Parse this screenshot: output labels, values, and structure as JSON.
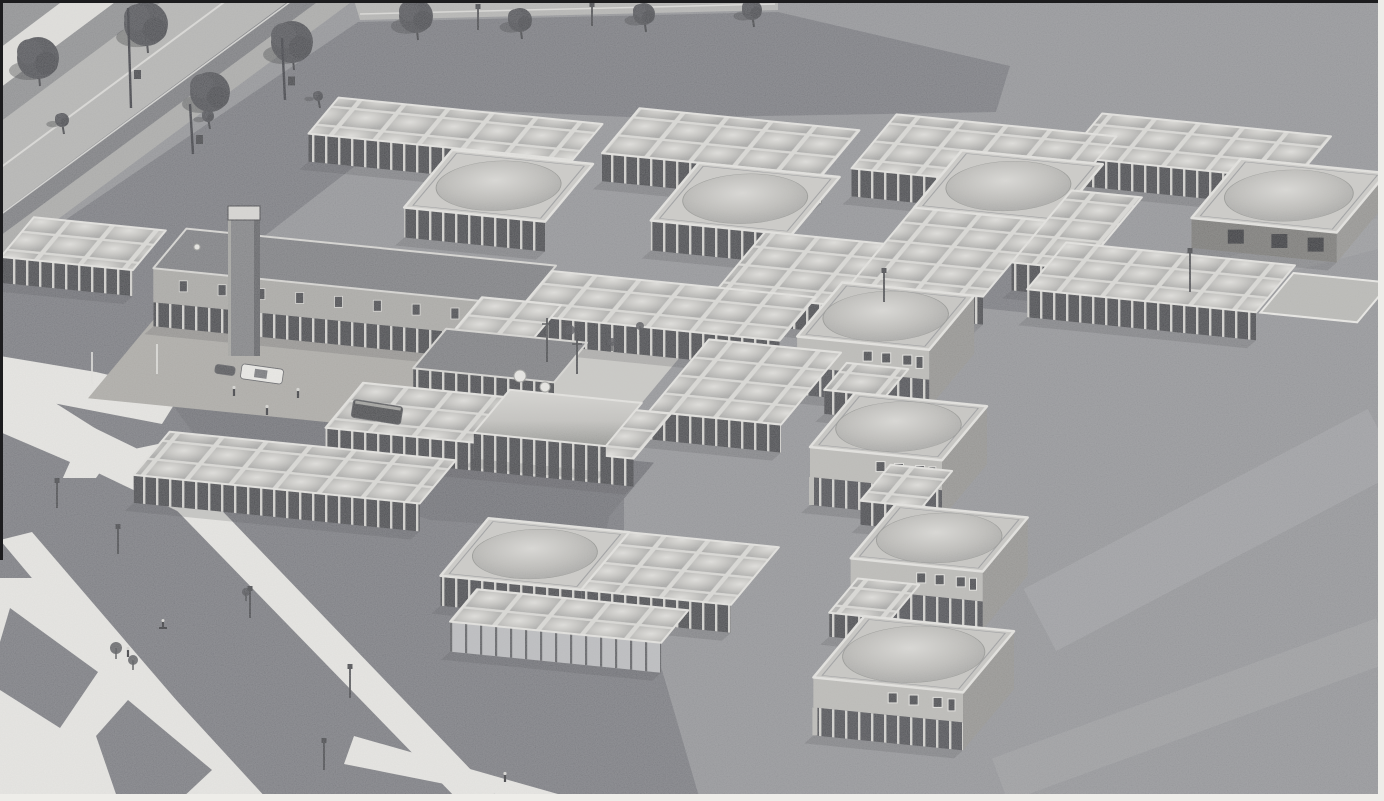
{
  "meta": {
    "title": "Aerial photograph of a modular pavilion building complex",
    "description": "Black-and-white oblique aerial photograph of a sprawling low-rise building complex composed of a carpet of square roof modules with domed skylights, larger pyramid-roofed pavilions, a long two-storey wing with a tower, and stepped two-storey dwelling blocks, surrounded by dark lawns, a tree-lined road at the upper left, bright diagonal footpaths at the lower left and a wide open field to the right."
  },
  "scene": {
    "palette": {
      "field": "#8e8f93",
      "lawn": "#73747a",
      "lawnDeep": "#696a70",
      "road": "#b2b2b0",
      "sidewalk": "#e3e2de",
      "verge": "#8a8b8d",
      "shadowBand": "#75767a",
      "cycle": "#a7a7a5",
      "path": "#eae9e5",
      "plaza": "#a9a7a2",
      "court": "#c9c8c4",
      "terrace": "#b6b6b2",
      "pavRoof": "#cbcac6",
      "houseRoof": "#c6c5c1",
      "spineRoof": "#76777b",
      "fascia": "#e7e6e2",
      "wallLight": "#c8c7c3",
      "wallWest": "#a8a7a3",
      "wallEast": "#8f8e8b",
      "plaster": "#b9b8b4",
      "glassDark": "#3e3f43",
      "glassLight": "#b9babd",
      "postLight": "#d3d2ce",
      "postDark": "#55565a",
      "darkWall": "#73726f",
      "tree": "#45464b",
      "shadow": "#3a3b3f",
      "white": "#eeede9",
      "ink": "#1c1c1e"
    },
    "basis": {
      "u": [
        44,
        4.4
      ],
      "v": [
        -15,
        18
      ],
      "origin": [
        60,
        60
      ]
    },
    "heights": {
      "grid": 28,
      "wing": 26,
      "link": 24,
      "pav": 30,
      "hall": 30,
      "house": 58,
      "spine": 58,
      "barrel": 26,
      "darkwing": 30
    },
    "ground": {
      "lawns": [
        {
          "points": [
            [
              358,
              22
            ],
            [
              778,
              12
            ],
            [
              1010,
              66
            ],
            [
              996,
              112
            ],
            [
              650,
              118
            ],
            [
              430,
              108
            ],
            [
              205,
              282
            ],
            [
              150,
              378
            ],
            [
              96,
              440
            ],
            [
              0,
              452
            ],
            [
              0,
              264
            ]
          ],
          "color": "lawn"
        },
        {
          "points": [
            [
              0,
              396
            ],
            [
              170,
              402
            ],
            [
              540,
              414
            ],
            [
              624,
              470
            ],
            [
              624,
              540
            ],
            [
              700,
              800
            ],
            [
              0,
              800
            ]
          ],
          "color": "lawn"
        },
        {
          "points": [
            [
              172,
              404
            ],
            [
              540,
              416
            ],
            [
              618,
              472
            ],
            [
              606,
              532
            ],
            [
              430,
              520
            ],
            [
              198,
              440
            ]
          ],
          "color": "lawnDeep"
        }
      ],
      "roads": [
        {
          "points": [
            [
              0,
              0
            ],
            [
              64,
              0
            ],
            [
              0,
              48
            ]
          ],
          "color": "verge"
        },
        {
          "points": [
            [
              64,
              0
            ],
            [
              118,
              0
            ],
            [
              0,
              88
            ],
            [
              0,
              48
            ]
          ],
          "color": "sidewalk"
        },
        {
          "points": [
            [
              118,
              0
            ],
            [
              164,
              0
            ],
            [
              0,
              122
            ],
            [
              0,
              88
            ]
          ],
          "color": "verge"
        },
        {
          "points": [
            [
              164,
              0
            ],
            [
              290,
              0
            ],
            [
              0,
              214
            ],
            [
              0,
              122
            ]
          ],
          "color": "road"
        },
        {
          "points": [
            [
              290,
              0
            ],
            [
              320,
              0
            ],
            [
              0,
              236
            ],
            [
              0,
              214
            ]
          ],
          "color": "shadowBand"
        },
        {
          "points": [
            [
              320,
              0
            ],
            [
              354,
              0
            ],
            [
              0,
              262
            ],
            [
              0,
              236
            ]
          ],
          "color": "cycle"
        },
        {
          "points": [
            [
              354,
              0
            ],
            [
              778,
              0
            ],
            [
              778,
              10
            ],
            [
              360,
              20
            ]
          ],
          "color": "road"
        }
      ],
      "roadLines": [
        {
          "x1": 227,
          "y1": 0,
          "x2": 0,
          "y2": 168,
          "w": 2,
          "op": 0.7
        },
        {
          "x1": 290,
          "y1": 2,
          "x2": 0,
          "y2": 215,
          "w": 1.5,
          "op": 0.8
        },
        {
          "x1": 360,
          "y1": 14,
          "x2": 775,
          "y2": 4,
          "w": 1.5,
          "op": 0.7
        }
      ],
      "paths": [
        {
          "points": [
            [
              0,
              356
            ],
            [
              96,
              372
            ],
            [
              182,
              392
            ],
            [
              162,
              424
            ],
            [
              58,
              404
            ],
            [
              0,
              398
            ]
          ]
        },
        {
          "points": [
            [
              0,
              368
            ],
            [
              120,
              444
            ],
            [
              96,
              478
            ],
            [
              0,
              478
            ]
          ]
        },
        {
          "points": [
            [
              0,
              382
            ],
            [
              214,
              486
            ],
            [
              196,
              520
            ],
            [
              0,
              426
            ]
          ]
        },
        {
          "points": [
            [
              120,
              452
            ],
            [
              158,
              444
            ],
            [
              500,
              800
            ],
            [
              458,
              800
            ]
          ]
        },
        {
          "points": [
            [
              0,
              540
            ],
            [
              32,
              532
            ],
            [
              262,
              800
            ],
            [
              218,
              800
            ]
          ]
        },
        {
          "points": [
            [
              0,
              578
            ],
            [
              64,
              578
            ],
            [
              268,
              800
            ],
            [
              0,
              800
            ]
          ]
        },
        {
          "points": [
            [
              354,
              736
            ],
            [
              600,
              806
            ],
            [
              556,
              806
            ],
            [
              344,
              764
            ]
          ]
        }
      ],
      "patches": [
        {
          "points": [
            [
              10,
              608
            ],
            [
              98,
              672
            ],
            [
              60,
              728
            ],
            [
              0,
              690
            ],
            [
              0,
              642
            ]
          ]
        },
        {
          "points": [
            [
              128,
              700
            ],
            [
              212,
              770
            ],
            [
              180,
              800
            ],
            [
              118,
              800
            ],
            [
              96,
              736
            ]
          ]
        },
        {
          "points": [
            [
              0,
              432
            ],
            [
              70,
              462
            ],
            [
              44,
              520
            ],
            [
              0,
              506
            ]
          ]
        }
      ],
      "courts": [
        {
          "x": 12.2,
          "y": 10.8,
          "w": 6,
          "h": 4.6,
          "color": "court"
        },
        {
          "x": 6.5,
          "y": 12,
          "w": 7,
          "h": 5.2,
          "color": "plaza"
        },
        {
          "x": 29.6,
          "y": 4.6,
          "w": 2.2,
          "h": 2.2,
          "color": "terrace",
          "stroke": "white"
        },
        {
          "x": 18.3,
          "y": 5.6,
          "w": 2,
          "h": 2.6,
          "color": "lawn"
        },
        {
          "x": 23.5,
          "y": 5.6,
          "w": 1.4,
          "h": 2.4,
          "color": "lawn"
        },
        {
          "x": 14.5,
          "y": 17.6,
          "w": 5,
          "h": 3.6,
          "color": "lawnDeep"
        }
      ],
      "streaks": [
        {
          "x1": 1040,
          "y1": 620,
          "x2": 1384,
          "y2": 440,
          "w": 70,
          "op": 0.1
        },
        {
          "x1": 1000,
          "y1": 780,
          "x2": 1384,
          "y2": 640,
          "w": 46,
          "op": 0.08
        },
        {
          "x1": 1120,
          "y1": 300,
          "x2": 1384,
          "y2": 232,
          "w": 30,
          "op": 0.06
        }
      ]
    },
    "blocks": [
      {
        "name": "north-arm-1",
        "type": "grid",
        "x": 6.5,
        "y": 0.5,
        "w": 6,
        "h": 2
      },
      {
        "name": "north-arm-2",
        "type": "grid",
        "x": 13,
        "y": -0.5,
        "w": 5,
        "h": 2.5
      },
      {
        "name": "north-arm-3",
        "type": "grid",
        "x": 18.5,
        "y": -1.5,
        "w": 5,
        "h": 3
      },
      {
        "name": "north-arm-4",
        "type": "grid",
        "x": 22.8,
        "y": -2.6,
        "w": 5.2,
        "h": 2.4
      },
      {
        "name": "pavilion-ne",
        "type": "pav",
        "x": 26.5,
        "y": -1,
        "w": 3.3,
        "h": 3.3,
        "walls": "dark",
        "east": true
      },
      {
        "name": "pavilion-n3",
        "type": "pav",
        "x": 20.5,
        "y": 0,
        "w": 3.2,
        "h": 3.2
      },
      {
        "name": "pavilion-n1",
        "type": "pav",
        "x": 9.8,
        "y": 2.6,
        "w": 3.2,
        "h": 3.2
      },
      {
        "name": "pavilion-n2",
        "type": "pav",
        "x": 15.2,
        "y": 2,
        "w": 3.2,
        "h": 3.2
      },
      {
        "name": "link-ne",
        "type": "grid",
        "x": 23.5,
        "y": 1.5,
        "w": 1.6,
        "h": 4
      },
      {
        "name": "grid-mid-right",
        "type": "grid",
        "x": 20.5,
        "y": 3.2,
        "w": 3,
        "h": 4.2
      },
      {
        "name": "east-wing",
        "type": "grid",
        "x": 24.3,
        "y": 4.2,
        "w": 5.2,
        "h": 2.6
      },
      {
        "name": "west-annex",
        "type": "wing",
        "x": 2.2,
        "y": 8.2,
        "w": 3,
        "h": 2.2
      },
      {
        "name": "grid-center",
        "type": "grid",
        "x": 17.8,
        "y": 5.2,
        "w": 2.7,
        "h": 3.4
      },
      {
        "name": "main-wing",
        "type": "spine",
        "x": 5.6,
        "y": 8,
        "w": 8.4,
        "h": 2.2,
        "tower": true
      },
      {
        "name": "court-north-band",
        "type": "grid",
        "x": 14,
        "y": 8.3,
        "w": 6,
        "h": 2.4
      },
      {
        "name": "dwelling-1",
        "type": "house",
        "x": 20.3,
        "y": 7.4,
        "w": 3,
        "h": 3,
        "east": true
      },
      {
        "name": "court-west-band",
        "type": "grid",
        "x": 13,
        "y": 10,
        "w": 1.8,
        "h": 2.2
      },
      {
        "name": "corridor-wing",
        "type": "darkwing",
        "x": 12.8,
        "y": 11.8,
        "w": 3.2,
        "h": 2.2
      },
      {
        "name": "court-east-band",
        "type": "grid",
        "x": 18.5,
        "y": 11,
        "w": 3,
        "h": 4
      },
      {
        "name": "link-1",
        "type": "link",
        "x": 21.8,
        "y": 11.5,
        "w": 1.4,
        "h": 1.5
      },
      {
        "name": "south-band",
        "type": "grid",
        "x": 12,
        "y": 15,
        "w": 7,
        "h": 2.5
      },
      {
        "name": "vaulted-hall",
        "type": "barrel",
        "x": 15.2,
        "y": 14.6,
        "w": 3,
        "h": 2.4,
        "zBias": 30
      },
      {
        "name": "dwelling-2",
        "type": "house",
        "x": 22.5,
        "y": 13,
        "w": 3,
        "h": 3,
        "east": true
      },
      {
        "name": "southwest-wing",
        "type": "grid",
        "x": 8.8,
        "y": 18.5,
        "w": 6.5,
        "h": 2.4
      },
      {
        "name": "link-2",
        "type": "link",
        "x": 24.5,
        "y": 16.5,
        "w": 1.4,
        "h": 2
      },
      {
        "name": "dwelling-3",
        "type": "house",
        "x": 25.3,
        "y": 18.5,
        "w": 3,
        "h": 3,
        "east": true
      },
      {
        "name": "pavilion-s",
        "type": "pav",
        "x": 17,
        "y": 21.3,
        "w": 3.2,
        "h": 3.2
      },
      {
        "name": "grid-south",
        "type": "grid",
        "x": 20.2,
        "y": 21.3,
        "w": 3.4,
        "h": 3.2
      },
      {
        "name": "link-3",
        "type": "link",
        "x": 25.8,
        "y": 22.5,
        "w": 1.4,
        "h": 1.9
      },
      {
        "name": "glass-hall",
        "type": "hall",
        "x": 18,
        "y": 25,
        "w": 4.8,
        "h": 1.8
      },
      {
        "name": "dwelling-4",
        "type": "house",
        "x": 26.6,
        "y": 24.4,
        "w": 3.4,
        "h": 3.4,
        "east": true
      }
    ],
    "details": {
      "trees": [
        [
          38,
          58,
          21
        ],
        [
          146,
          24,
          22
        ],
        [
          210,
          92,
          20
        ],
        [
          292,
          42,
          21
        ],
        [
          416,
          16,
          17
        ],
        [
          520,
          20,
          12
        ],
        [
          644,
          14,
          11
        ],
        [
          752,
          10,
          10
        ],
        [
          62,
          120,
          7
        ],
        [
          208,
          116,
          6
        ],
        [
          318,
          96,
          5
        ]
      ],
      "saplings": [
        [
          570,
          330,
          5
        ],
        [
          612,
          342,
          4
        ],
        [
          640,
          326,
          4
        ],
        [
          116,
          648,
          6
        ],
        [
          133,
          660,
          5
        ],
        [
          246,
          592,
          4
        ]
      ],
      "lamps": [
        [
          57,
          482,
          26
        ],
        [
          118,
          528,
          26
        ],
        [
          250,
          590,
          28
        ],
        [
          350,
          668,
          30
        ],
        [
          324,
          742,
          28
        ],
        [
          478,
          8,
          22
        ],
        [
          592,
          6,
          20
        ],
        [
          1190,
          252,
          40
        ],
        [
          884,
          272,
          30
        ]
      ],
      "masts": [
        [
          128,
          8,
          100
        ],
        [
          190,
          104,
          50
        ],
        [
          282,
          38,
          62
        ]
      ],
      "flagpoles": [
        [
          92,
          352,
          32
        ],
        [
          157,
          344,
          30
        ]
      ],
      "courtPoles": [
        [
          547,
          318,
          44
        ],
        [
          577,
          338,
          36
        ]
      ],
      "cars": [
        {
          "cx": 262,
          "cy": 374,
          "w": 42,
          "h": 15,
          "angle": 8,
          "kind": "white-car"
        },
        {
          "cx": 225,
          "cy": 370,
          "w": 20,
          "h": 9,
          "angle": 8,
          "kind": "dark-car"
        },
        {
          "cx": 377,
          "cy": 412,
          "w": 50,
          "h": 18,
          "angle": 9,
          "kind": "van"
        }
      ],
      "people": [
        [
          234,
          389
        ],
        [
          298,
          391
        ],
        [
          267,
          408
        ],
        [
          128,
          650
        ],
        [
          505,
          775
        ]
      ],
      "cyclist": [
        163,
        622
      ],
      "vents": [
        [
          520,
          376,
          6
        ],
        [
          545,
          387,
          5
        ],
        [
          197,
          247,
          3
        ]
      ]
    }
  }
}
